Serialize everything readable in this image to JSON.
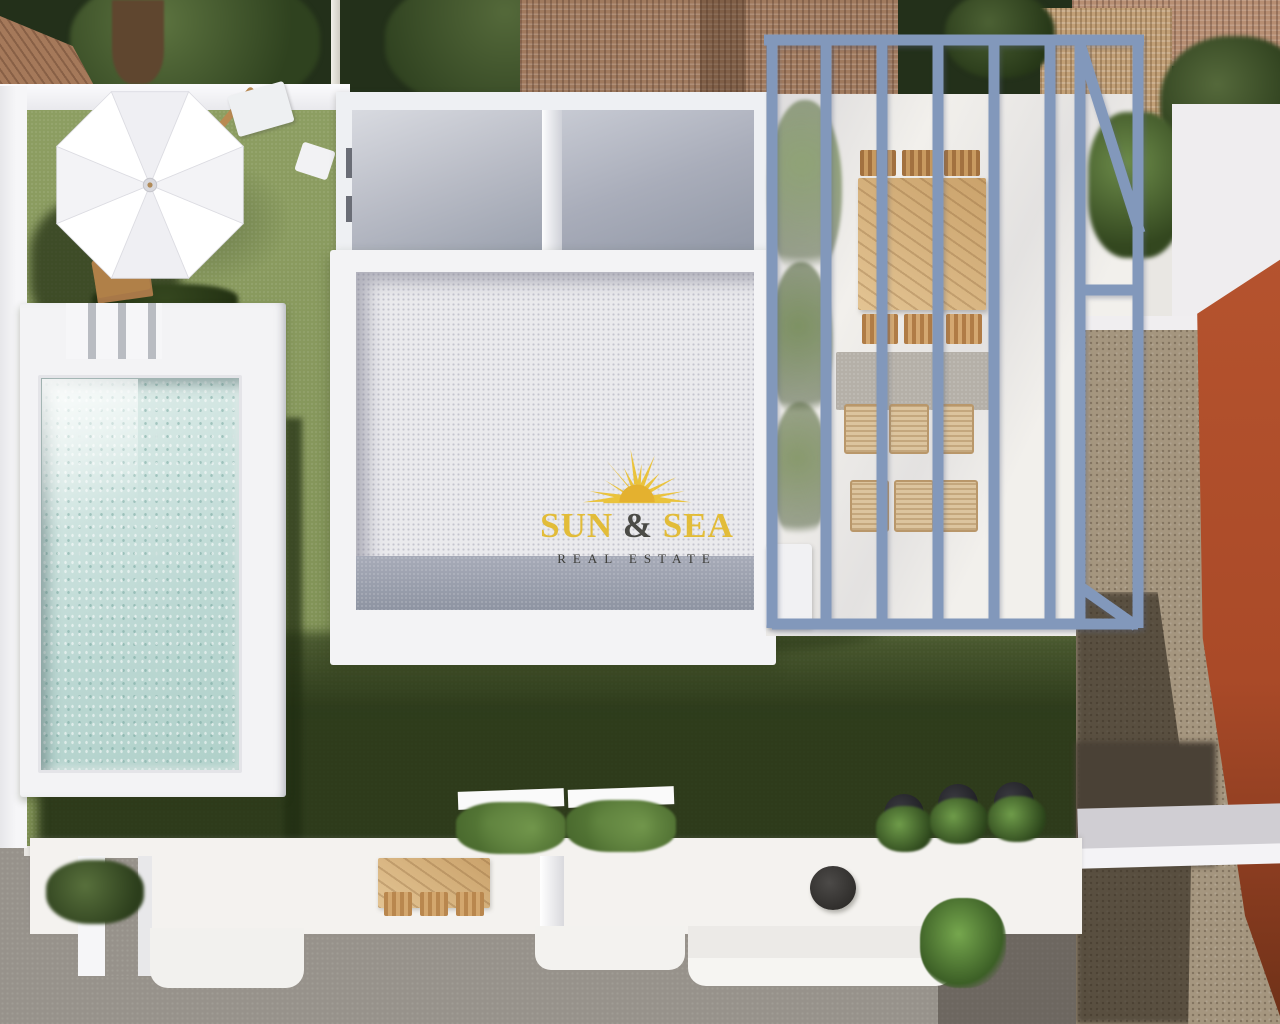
{
  "watermark": {
    "brand": {
      "word1": "SUN",
      "ampersand": "&",
      "word2": "SEA"
    },
    "subtitle": "REAL ESTATE",
    "colors": {
      "brand": "#e2bc39",
      "ampersand": "#4a4a46",
      "subtitle": "#3c3c38",
      "sun_icon": "#eac33c"
    }
  },
  "scene": {
    "type": "aerial-3d-architectural-render",
    "subject": "Top-down 3D render of a modern white villa plot with pool, lawn, pergola terrace and street pavement",
    "objects": [
      {
        "name": "patio-umbrella",
        "description": "white octagonal parasol on lawn, top left"
      },
      {
        "name": "sun-lounger",
        "description": "wooden lounger with pale cushion beside umbrella"
      },
      {
        "name": "swimming-pool",
        "description": "rectangular pool with light turquoise water on raised white deck, left side"
      },
      {
        "name": "pool-steps",
        "description": "white access steps at top of pool deck"
      },
      {
        "name": "villa-rooms",
        "description": "open-top room layout with white walls and grey floors, top centre"
      },
      {
        "name": "gravel-roof",
        "description": "white gravel flat roof block with grey border band, centre"
      },
      {
        "name": "pergola",
        "description": "blue-grey steel pergola frame over white terrace, top right"
      },
      {
        "name": "outdoor-dining-set",
        "description": "light wooden table with six chairs under pergola"
      },
      {
        "name": "wicker-lounge",
        "description": "rattan lounge seating on grey rug under pergola"
      },
      {
        "name": "lawn",
        "description": "olive green lawn crossed by long building shadow"
      },
      {
        "name": "planters",
        "description": "two white planters with dark green shrubs at front walk"
      },
      {
        "name": "front-terrace",
        "description": "white front terrace with wooden bistro set and round black table"
      },
      {
        "name": "potted-plants",
        "description": "three black pots with green plants on terrace edge"
      },
      {
        "name": "fern",
        "description": "small green fern at front steps"
      },
      {
        "name": "dirt-yard",
        "description": "brown unpaved side yard on the right"
      },
      {
        "name": "orange-wall",
        "description": "terracotta neighbouring wall along right edge"
      },
      {
        "name": "street-pavement",
        "description": "grey pavement across the bottom and left edge"
      },
      {
        "name": "neighbour-roofs",
        "description": "clay tile roofs, wicker canopy and dark green trees along the top"
      }
    ],
    "palette": {
      "lawn": "#84955c",
      "lawn_shadow": "#3e5126",
      "pool_water": "#bfdad5",
      "deck_white": "#f3f3f5",
      "roof_gravel": "#e9e9ec",
      "roof_band": "#979daa",
      "pergola": "#8298bb",
      "wood": "#cda46e",
      "wicker": "#dcc49e",
      "dirt": "#a5967f",
      "orange_wall": "#b5532e",
      "pavement": "#97928b",
      "trees": "#2c3a1f",
      "brick_roof": "#a07a5e"
    }
  }
}
